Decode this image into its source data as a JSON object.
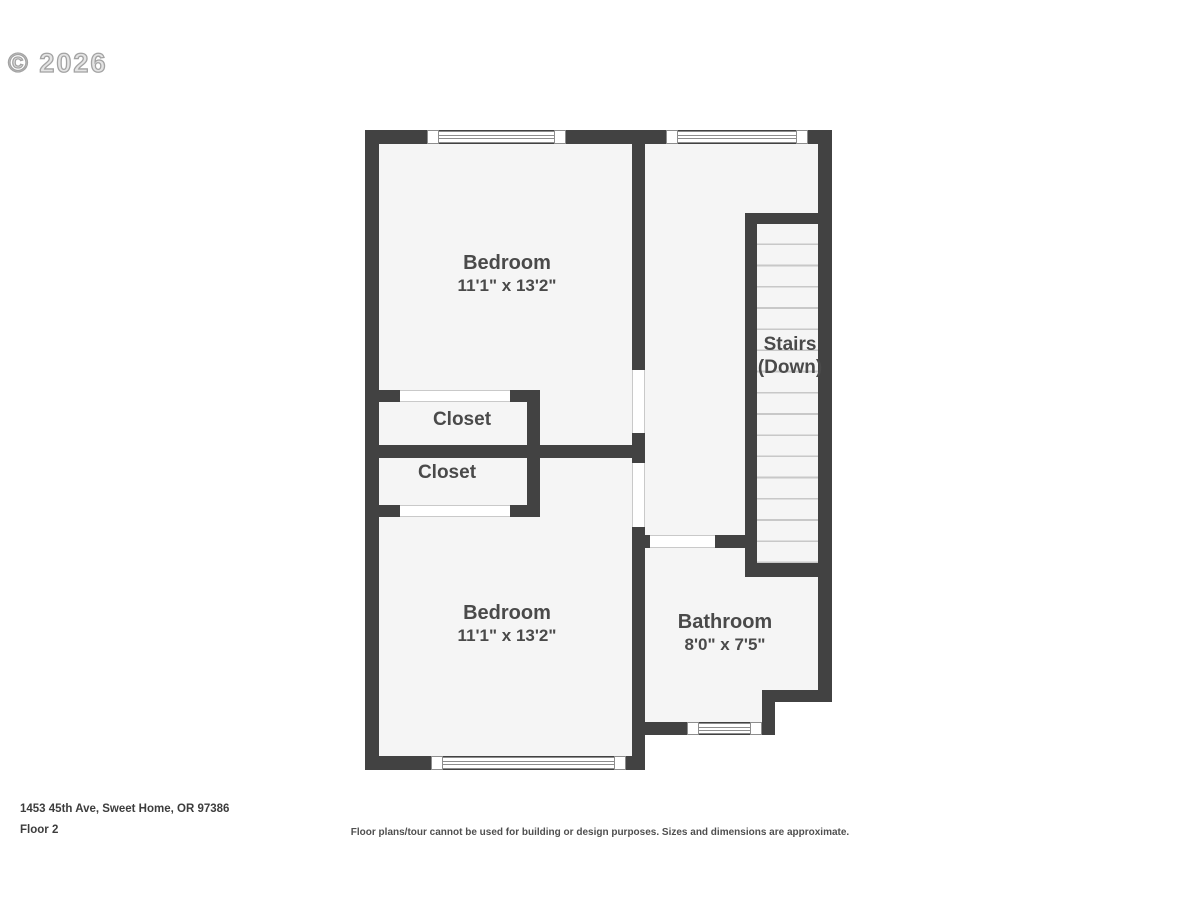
{
  "watermark": "© 2026",
  "plan": {
    "rooms": {
      "bedroom_top": {
        "name": "Bedroom",
        "dims": "11'1\" x 13'2\""
      },
      "closet_top": {
        "name": "Closet"
      },
      "closet_bottom": {
        "name": "Closet"
      },
      "bedroom_bottom": {
        "name": "Bedroom",
        "dims": "11'1\" x 13'2\""
      },
      "bathroom": {
        "name": "Bathroom",
        "dims": "8'0\" x 7'5\""
      },
      "stairs": {
        "name": "Stairs",
        "down": "(Down)"
      }
    }
  },
  "footer": {
    "address": "1453 45th Ave, Sweet Home, OR 97386",
    "floor": "Floor 2",
    "disclaimer": "Floor plans/tour cannot be used for building or design purposes. Sizes and dimensions are approximate."
  },
  "colors": {
    "wall": "#424242",
    "room_fill": "#f5f5f5",
    "label_text": "#4a4a4a",
    "stair_tread_line": "#c8c8c8",
    "watermark": "#a3a3a3"
  }
}
